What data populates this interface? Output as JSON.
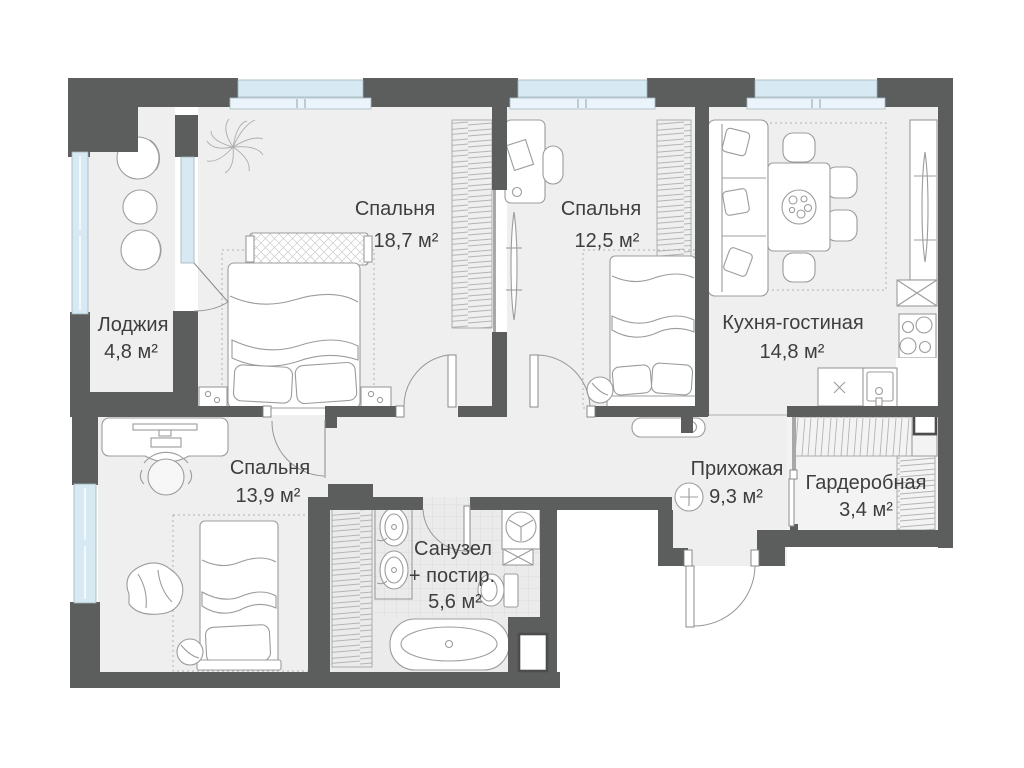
{
  "plan": {
    "type": "apartment-floor-plan",
    "language": "ru",
    "rooms": [
      {
        "id": "loggia",
        "name": "Лоджия",
        "area": "4,8 м²"
      },
      {
        "id": "bedroom-1",
        "name": "Спальня",
        "area": "18,7 м²"
      },
      {
        "id": "bedroom-2",
        "name": "Спальня",
        "area": "12,5 м²"
      },
      {
        "id": "kitchen-living",
        "name": "Кухня-гостиная",
        "area": "14,8 м²"
      },
      {
        "id": "bedroom-3",
        "name": "Спальня",
        "area": "13,9 м²"
      },
      {
        "id": "hallway",
        "name": "Прихожая",
        "area": "9,3 м²"
      },
      {
        "id": "bathroom",
        "name": "Санузел",
        "name_2": "+ постир.",
        "area": "5,6 м²"
      },
      {
        "id": "wardrobe",
        "name": "Гардеробная",
        "area": "3,4 м²"
      }
    ],
    "colors": {
      "wall": "#5c5d5d",
      "window_glass": "#d7e9f3",
      "floor": "#efefef",
      "bathroom_floor": "#ebebeb",
      "furniture_line": "#9c9c9c",
      "label_text": "#3e3e3e",
      "background": "#ffffff"
    }
  }
}
